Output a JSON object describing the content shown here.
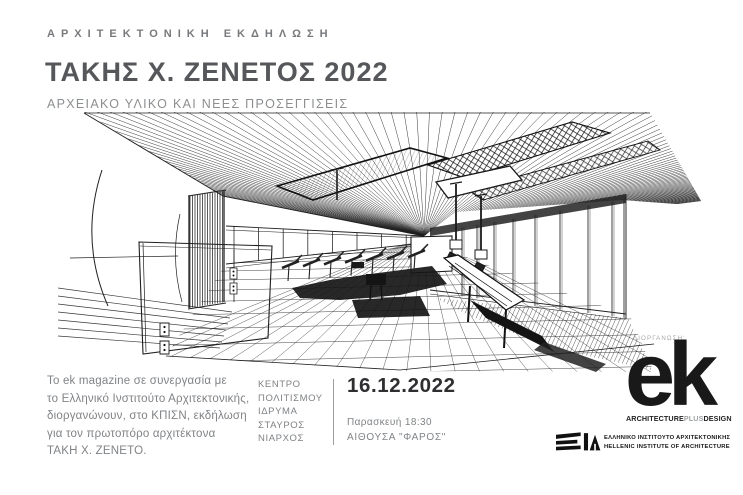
{
  "header": {
    "eyebrow": "ΑΡΧΙΤΕΚΤΟΝΙΚΗ ΕΚΔΗΛΩΣΗ",
    "title": "ΤΑΚΗΣ Χ. ΖΕΝΕΤΟΣ 2022",
    "subtitle": "ΑΡΧΕΙΑΚΟ ΥΛΙΚΟ ΚΑΙ ΝΕΕΣ ΠΡΟΣΕΓΓΙΣΕΙΣ"
  },
  "description": {
    "lines": [
      "Το ek magazine σε συνεργασία με",
      "το Ελληνικό Ινστιτούτο Αρχιτεκτονικής,",
      "διοργανώνουν, στο ΚΠΙΣΝ, εκδήλωση",
      "για τον πρωτοπόρο αρχιτέκτονα",
      "ΤΑΚΗ Χ. ΖΕΝΕΤΟ."
    ]
  },
  "event": {
    "venue_lines": [
      "ΚΕΝΤΡΟ",
      "ΠΟΛΙΤΙΣΜΟΥ",
      "ΙΔΡΥΜΑ",
      "ΣΤΑΥΡΟΣ",
      "ΝΙΑΡΧΟΣ"
    ],
    "date": "16.12.2022",
    "day_time": "Παρασκευή 18:30",
    "hall": "ΑΙΘΟΥΣΑ \"ΦΑΡΟΣ\""
  },
  "organizer": {
    "label": "ΔΙΟΡΓΑΝΩΣΗ:",
    "logo_text": "ek",
    "tagline_parts": [
      "ARCHITECTURE",
      "PLUS",
      "DESIGN"
    ]
  },
  "institute": {
    "line1": "ΕΛΛΗΝΙΚΟ ΙΝΣΤΙΤΟΥΤΟ ΑΡΧΙΤΕΚΤΟΝΙΚΗΣ",
    "line2": "HELLENIC INSTITUTE OF ARCHITECTURE"
  },
  "illustration": {
    "name": "architectural-interior-perspective-line-drawing"
  },
  "colors": {
    "title_gray": "#55575a",
    "text_gray": "#85888a",
    "ink_black": "#191919"
  }
}
